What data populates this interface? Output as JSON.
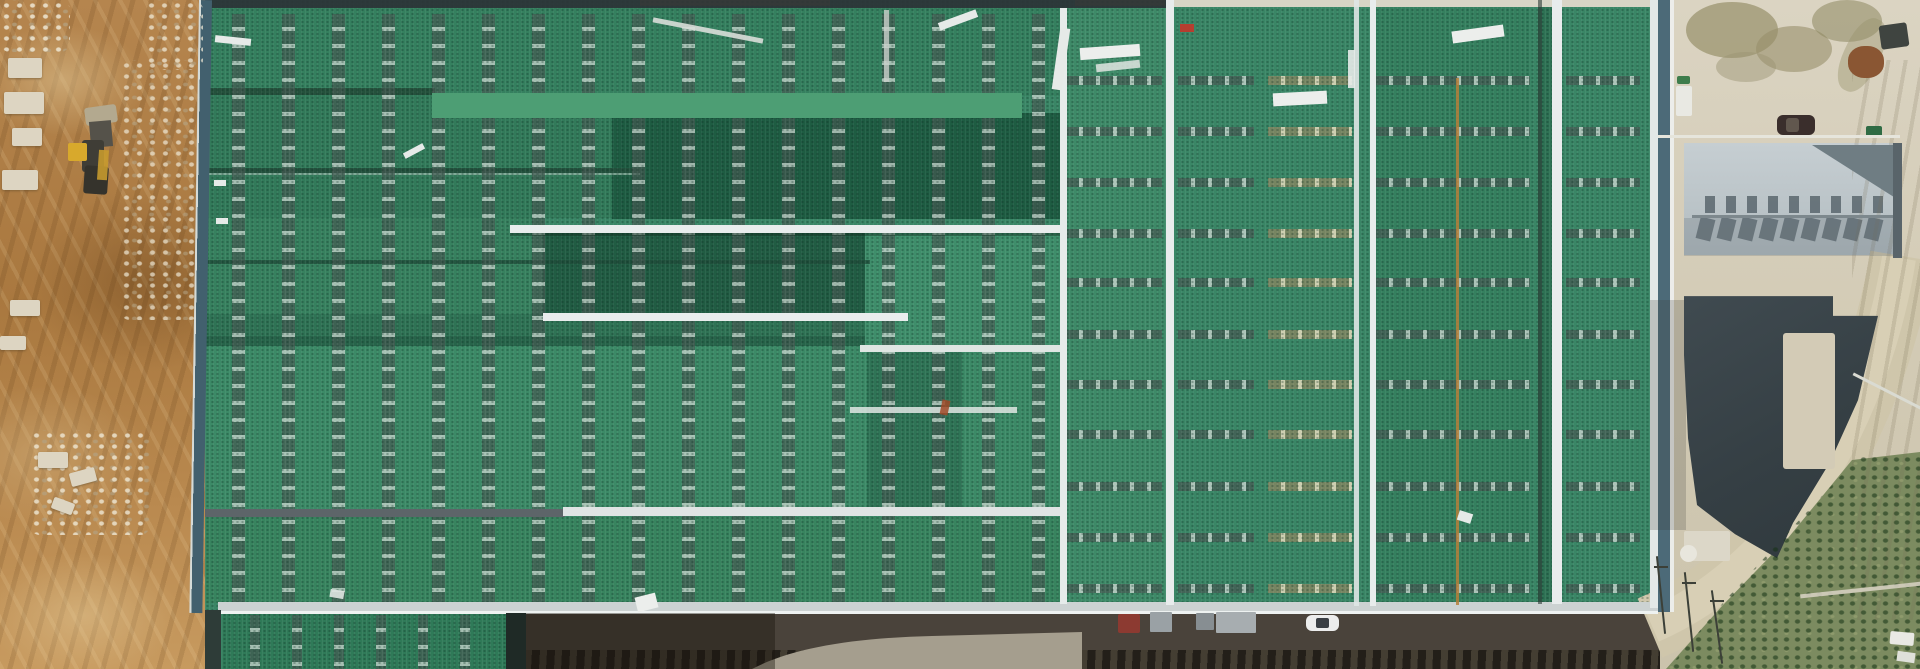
{
  "meta": {
    "title": "Aerial drone view of an industrial plant with large green metal roofs under construction"
  },
  "palette": {
    "dirt": "#b08049",
    "rubble": "#ddd5c2",
    "roof_green": "#3a8666",
    "roof_green_dark": "#1e5c42",
    "roof_green_bright": "#4d9e74",
    "seam_white": "#e8ecec",
    "edge_blue": "#4c6a78",
    "stripe_gray": "#8d9397",
    "stripe_tan": "#cdbf9e",
    "concrete": "#d6cfbc",
    "concrete_stain": "#97906a",
    "gray_roof_light": "#c6ced2",
    "gray_roof_mid": "#b2bcc0",
    "gray_roof_shadow": "#6f7d83",
    "charcoal_roof": "#39444a",
    "asphalt": "#4a433b",
    "road_light": "#a59e8e",
    "road_tan": "#cfc6ab",
    "road_tan_light": "#ddd5bc",
    "vegetation": "#7c8b60",
    "vegetation_dark": "#42613a",
    "excavator_yellow": "#d8a92c",
    "car_white": "#eceded",
    "truck_red": "#8c3a31",
    "car_dark": "#3a2e2c"
  },
  "scene": {
    "left_area": "Bare earth construction yard with wheel loader, rubble and tyre tracks",
    "main_area": "Large industrial hall with green metal roof, skylight vent strips, white walkways and ridge seams",
    "right_area": "Concrete yard with parked car, gray workshop building, dark curved roof, access road and scrub vegetation",
    "bottom_area": "Service road along the hall with red container truck, pallet stacks and a white car"
  },
  "stripes": {
    "columns": {
      "xs": [
        232,
        282,
        332,
        382,
        432,
        482,
        532,
        582,
        632,
        682,
        732,
        782,
        832,
        882,
        932,
        982,
        1032
      ],
      "top": 14,
      "height": 588
    },
    "lower": {
      "xs": [
        250,
        292,
        334,
        376,
        418,
        460
      ],
      "top": 615,
      "height": 54
    },
    "rows": {
      "ys": [
        76,
        127,
        178,
        229,
        278,
        330,
        380,
        430,
        482,
        533,
        584
      ],
      "bays": [
        {
          "x": 1066,
          "w": 96,
          "tan": false
        },
        {
          "x": 1178,
          "w": 76,
          "tan": false
        },
        {
          "x": 1268,
          "w": 84,
          "tan": true
        },
        {
          "x": 1376,
          "w": 154,
          "tan": false
        },
        {
          "x": 1566,
          "w": 74,
          "tan": false
        }
      ]
    }
  },
  "gray_building": {
    "teeth": {
      "x0": 1705,
      "step": 21,
      "count": 9,
      "sq_y": 196,
      "sh_y": 218
    }
  },
  "under": [
    {
      "n": "roof-band-top",
      "x": 205,
      "y": 8,
      "w": 857,
      "h": 88,
      "c": "#35805f"
    },
    {
      "n": "roof-ridge-dark",
      "x": 205,
      "y": 88,
      "w": 230,
      "h": 7,
      "c": "#24513c"
    },
    {
      "n": "roof-band-upper-left",
      "x": 205,
      "y": 95,
      "w": 407,
      "h": 123,
      "c": "#327a5a"
    },
    {
      "n": "roof-dark-rect",
      "x": 612,
      "y": 113,
      "w": 450,
      "h": 106,
      "c": "#1e5c42"
    },
    {
      "n": "roof-step-edge",
      "x": 205,
      "y": 168,
      "w": 435,
      "h": 5,
      "c": "#22503c"
    },
    {
      "n": "roof-step-highlight",
      "x": 205,
      "y": 173,
      "w": 435,
      "h": 2,
      "c": "#9fc2b2",
      "o": 0.7
    },
    {
      "n": "roof-band-mid-left",
      "x": 205,
      "y": 218,
      "w": 338,
      "h": 96,
      "c": "#37815f"
    },
    {
      "n": "roof-dark-bay",
      "x": 543,
      "y": 233,
      "w": 322,
      "h": 80,
      "c": "#215c43"
    },
    {
      "n": "roof-light-bay",
      "x": 865,
      "y": 233,
      "w": 197,
      "h": 112,
      "c": "#3f8e6b"
    },
    {
      "n": "roof-ridge-line",
      "x": 205,
      "y": 260,
      "w": 665,
      "h": 4,
      "c": "#1f4c39",
      "o": 0.8
    },
    {
      "n": "roof-band-4-left",
      "x": 205,
      "y": 314,
      "w": 660,
      "h": 22,
      "c": "#2f7355"
    },
    {
      "n": "roof-step-shadow",
      "x": 205,
      "y": 336,
      "w": 660,
      "h": 10,
      "c": "#27644a"
    },
    {
      "n": "roof-main-field",
      "x": 205,
      "y": 346,
      "w": 857,
      "h": 163,
      "c": "#3c8a67"
    },
    {
      "n": "roof-dark-strip-mid",
      "x": 867,
      "y": 346,
      "w": 95,
      "h": 163,
      "c": "#2f7456"
    },
    {
      "n": "roof-band-lower",
      "x": 205,
      "y": 517,
      "w": 857,
      "h": 86,
      "c": "#38845f"
    },
    {
      "n": "roof-mid-column",
      "x": 1062,
      "y": 8,
      "w": 104,
      "h": 596,
      "c": "#3e8a68"
    },
    {
      "n": "roof-right-block",
      "x": 1166,
      "y": 6,
      "w": 484,
      "h": 598,
      "c": "#3a8666"
    },
    {
      "n": "roof-bay-2",
      "x": 1376,
      "y": 6,
      "w": 154,
      "h": 598,
      "c": "#35805f"
    },
    {
      "n": "roof-bay-narrow",
      "x": 1538,
      "y": 6,
      "w": 14,
      "h": 598,
      "c": "#2e7254"
    },
    {
      "n": "top-dirt-gap",
      "x": 640,
      "y": 0,
      "w": 190,
      "h": 6,
      "c": "#a87c4a",
      "o": 0.9
    },
    {
      "n": "top-dirt-gap",
      "x": 1075,
      "y": 0,
      "w": 90,
      "h": 6,
      "c": "#a87c4a",
      "o": 0.8
    }
  ],
  "over": [
    {
      "n": "roof-eave-top-dark",
      "x": 205,
      "y": 0,
      "w": 962,
      "h": 8,
      "c": "#2b3336",
      "o": 0.92
    },
    {
      "n": "roof-eave-top-light",
      "x": 1167,
      "y": 0,
      "w": 488,
      "h": 7,
      "c": "#d8d5c6"
    },
    {
      "n": "roof-bright-ridge",
      "cls": "corr",
      "x": 432,
      "y": 93,
      "w": 590,
      "h": 25,
      "c": "#4d9e74"
    },
    {
      "n": "roof-walkway",
      "x": 510,
      "y": 225,
      "w": 553,
      "h": 8,
      "c": "#e9eded"
    },
    {
      "n": "roof-walkway-shadow",
      "x": 510,
      "y": 233,
      "w": 553,
      "h": 3,
      "c": "rgba(15,40,28,0.4)"
    },
    {
      "n": "roof-walkway",
      "x": 543,
      "y": 313,
      "w": 365,
      "h": 8,
      "c": "#e9eded"
    },
    {
      "n": "roof-step-white",
      "x": 860,
      "y": 345,
      "w": 203,
      "h": 7,
      "c": "#dfe6e3"
    },
    {
      "n": "roof-step-white",
      "x": 850,
      "y": 407,
      "w": 167,
      "h": 6,
      "c": "#dfe6e3",
      "o": 0.85
    },
    {
      "n": "roof-gray-bar",
      "x": 205,
      "y": 509,
      "w": 360,
      "h": 8,
      "c": "#5d6569"
    },
    {
      "n": "roof-white-bar",
      "x": 563,
      "y": 507,
      "w": 499,
      "h": 9,
      "c": "#dfe4e4"
    },
    {
      "n": "roof-eave-walkway",
      "x": 218,
      "y": 602,
      "w": 1440,
      "h": 11,
      "c": "#ccd2d2"
    },
    {
      "n": "roof-eave-walkway-edge",
      "x": 218,
      "y": 611,
      "w": 1440,
      "h": 3,
      "c": "#eef2f1"
    },
    {
      "n": "roof-seam-vertical",
      "x": 1060,
      "y": 8,
      "w": 7,
      "h": 596,
      "c": "#e6ebea"
    },
    {
      "n": "roof-seam-vertical",
      "x": 1166,
      "y": 0,
      "w": 8,
      "h": 605,
      "c": "#e8ecec"
    },
    {
      "n": "roof-seam-vertical",
      "x": 1354,
      "y": 0,
      "w": 5,
      "h": 606,
      "c": "#dfe5e4",
      "o": 0.9
    },
    {
      "n": "roof-seam-vertical",
      "x": 1370,
      "y": 0,
      "w": 6,
      "h": 606,
      "c": "#e8ecec"
    },
    {
      "n": "roof-seam-dark",
      "x": 1538,
      "y": 0,
      "w": 4,
      "h": 604,
      "c": "#2c3a36",
      "o": 0.6
    },
    {
      "n": "roof-seam-vertical",
      "x": 1552,
      "y": 0,
      "w": 10,
      "h": 604,
      "c": "#e8ecec"
    },
    {
      "n": "roof-rust-line",
      "x": 1456,
      "y": 78,
      "w": 3,
      "h": 527,
      "c": "#b5803c",
      "o": 0.85
    },
    {
      "n": "roof-seam-vertical",
      "x": 1650,
      "y": 0,
      "w": 8,
      "h": 608,
      "c": "#e3e8e7"
    },
    {
      "n": "building-right-edge",
      "x": 1658,
      "y": 0,
      "w": 12,
      "h": 612,
      "c": "#4c6a78"
    },
    {
      "n": "building-right-edge-line",
      "x": 1670,
      "y": 0,
      "w": 4,
      "h": 612,
      "c": "#eef0ee",
      "o": 0.9
    },
    {
      "n": "building-left-edge",
      "cls": "ledge",
      "x": 199,
      "y": 0,
      "w": 13,
      "h": 613
    },
    {
      "n": "building-left-edge-lower",
      "x": 205,
      "y": 610,
      "w": 16,
      "h": 59,
      "c": "#2e3c38"
    },
    {
      "n": "debris-plank",
      "x": 215,
      "y": 37,
      "w": 36,
      "h": 7,
      "c": "#e6eae8",
      "rot": 6
    },
    {
      "n": "debris-plank",
      "x": 214,
      "y": 180,
      "w": 12,
      "h": 6,
      "c": "#e6eae8"
    },
    {
      "n": "debris-plank",
      "x": 216,
      "y": 218,
      "w": 12,
      "h": 6,
      "c": "#e6eae8"
    },
    {
      "n": "debris-plank",
      "x": 403,
      "y": 148,
      "w": 22,
      "h": 6,
      "c": "#e6eae8",
      "rot": -28
    },
    {
      "n": "debris-plank",
      "x": 652,
      "y": 28,
      "w": 112,
      "h": 5,
      "c": "#d9ded9",
      "rot": 11,
      "o": 0.9
    },
    {
      "n": "debris-plank",
      "x": 884,
      "y": 10,
      "w": 5,
      "h": 72,
      "c": "#c9d0ca",
      "o": 0.8
    },
    {
      "n": "debris-plank",
      "x": 938,
      "y": 16,
      "w": 40,
      "h": 8,
      "c": "#e6eae8",
      "rot": -20
    },
    {
      "n": "debris-plank",
      "x": 1056,
      "y": 28,
      "w": 10,
      "h": 62,
      "c": "#e6eae8",
      "rot": 8
    },
    {
      "n": "debris-plank",
      "x": 1080,
      "y": 46,
      "w": 60,
      "h": 12,
      "c": "#eceeec",
      "rot": -4
    },
    {
      "n": "debris-plank",
      "x": 1096,
      "y": 62,
      "w": 44,
      "h": 8,
      "c": "#e0e5e2",
      "rot": -6,
      "o": 0.85
    },
    {
      "n": "debris-plank",
      "x": 1273,
      "y": 92,
      "w": 54,
      "h": 13,
      "c": "#eceeec",
      "rot": -3
    },
    {
      "n": "debris-plank",
      "x": 1348,
      "y": 50,
      "w": 7,
      "h": 38,
      "c": "#e6eae8",
      "o": 0.9
    },
    {
      "n": "debris-plank",
      "x": 1452,
      "y": 28,
      "w": 52,
      "h": 12,
      "c": "#eceeec",
      "rot": -8
    },
    {
      "n": "debris-red-mark",
      "x": 1180,
      "y": 24,
      "w": 14,
      "h": 8,
      "c": "#b53e30"
    },
    {
      "n": "debris-sheet",
      "x": 1458,
      "y": 512,
      "w": 14,
      "h": 10,
      "c": "#e6eae8",
      "rot": 18
    },
    {
      "n": "debris-sheet",
      "x": 636,
      "y": 595,
      "w": 21,
      "h": 15,
      "c": "#eceeec",
      "rot": -14
    },
    {
      "n": "debris-sheet",
      "x": 330,
      "y": 590,
      "w": 14,
      "h": 8,
      "c": "#e0e5e2",
      "rot": 10,
      "o": 0.9
    },
    {
      "n": "debris-rust-mark",
      "x": 941,
      "y": 400,
      "w": 8,
      "h": 15,
      "c": "#a14a28",
      "rot": 12,
      "o": 0.85
    },
    {
      "n": "rubble-patch",
      "cls": "rubble",
      "x": 120,
      "y": 60,
      "w": 80,
      "h": 260,
      "o": 0.75
    },
    {
      "n": "rubble-patch",
      "cls": "rubble",
      "x": 145,
      "y": 0,
      "w": 58,
      "h": 70,
      "o": 0.8
    },
    {
      "n": "rubble-patch",
      "cls": "rubble",
      "x": 0,
      "y": 0,
      "w": 70,
      "h": 52,
      "o": 0.9
    },
    {
      "n": "rubble-patch",
      "cls": "rubble",
      "x": 30,
      "y": 430,
      "w": 120,
      "h": 105,
      "o": 0.85
    },
    {
      "n": "stone-block",
      "cls": "stone",
      "x": 8,
      "y": 58,
      "w": 34,
      "h": 20
    },
    {
      "n": "stone-block",
      "cls": "stone",
      "x": 4,
      "y": 92,
      "w": 40,
      "h": 22
    },
    {
      "n": "stone-block",
      "cls": "stone",
      "x": 12,
      "y": 128,
      "w": 30,
      "h": 18
    },
    {
      "n": "stone-block",
      "cls": "stone",
      "x": 2,
      "y": 170,
      "w": 36,
      "h": 20
    },
    {
      "n": "stone-block",
      "cls": "stone",
      "x": 10,
      "y": 300,
      "w": 30,
      "h": 16
    },
    {
      "n": "stone-block",
      "cls": "stone",
      "x": 0,
      "y": 336,
      "w": 26,
      "h": 14
    },
    {
      "n": "stone-block",
      "cls": "stone",
      "x": 38,
      "y": 452,
      "w": 30,
      "h": 16
    },
    {
      "n": "stone-block",
      "cls": "stone",
      "x": 70,
      "y": 470,
      "w": 26,
      "h": 14,
      "rot": -15
    },
    {
      "n": "stone-block",
      "cls": "stone",
      "x": 52,
      "y": 500,
      "w": 22,
      "h": 12,
      "rot": 20
    },
    {
      "n": "excavator-bucket",
      "x": 85,
      "y": 106,
      "w": 32,
      "h": 18,
      "c": "#b3a98f",
      "rot": -8,
      "r": 3
    },
    {
      "n": "excavator-arm",
      "x": 90,
      "y": 121,
      "w": 22,
      "h": 26,
      "c": "#55524a",
      "rot": -5
    },
    {
      "n": "excavator-body",
      "x": 82,
      "y": 140,
      "w": 22,
      "h": 32,
      "c": "#3f3d36",
      "r": 3
    },
    {
      "n": "excavator-cab",
      "x": 68,
      "y": 143,
      "w": 19,
      "h": 18,
      "c": "#d8a92c",
      "r": 2
    },
    {
      "n": "excavator-rear",
      "x": 84,
      "y": 166,
      "w": 24,
      "h": 28,
      "c": "#35332c",
      "r": 3,
      "rot": 4
    },
    {
      "n": "excavator-side",
      "x": 98,
      "y": 150,
      "w": 10,
      "h": 30,
      "c": "#c79a2e",
      "o": 0.9,
      "rot": 4
    },
    {
      "n": "ground-shadow",
      "x": 525,
      "y": 613,
      "w": 250,
      "h": 56,
      "c": "rgba(25,20,12,0.4)"
    },
    {
      "n": "lower-roof-edge-shadow",
      "x": 506,
      "y": 613,
      "w": 20,
      "h": 56,
      "c": "#1f2a26"
    },
    {
      "n": "cargo-truck-red",
      "x": 1118,
      "y": 614,
      "w": 22,
      "h": 19,
      "c": "#8c3a31",
      "r": 2
    },
    {
      "n": "pallet-stack",
      "x": 1150,
      "y": 612,
      "w": 22,
      "h": 20,
      "c": "#9aa1a5",
      "r": 1
    },
    {
      "n": "pallet-stack",
      "x": 1196,
      "y": 613,
      "w": 18,
      "h": 17,
      "c": "#878e92",
      "r": 1
    },
    {
      "n": "pallet-stack",
      "x": 1216,
      "y": 612,
      "w": 40,
      "h": 21,
      "c": "#a7adb0",
      "r": 1
    },
    {
      "n": "car-white",
      "x": 1306,
      "y": 615,
      "w": 33,
      "h": 16,
      "c": "#eceded",
      "r": 6
    },
    {
      "n": "car-white-windshield",
      "x": 1316,
      "y": 618,
      "w": 13,
      "h": 10,
      "c": "#3a3f44",
      "r": 2
    },
    {
      "n": "concrete-stain",
      "x": 1686,
      "y": 2,
      "w": 92,
      "h": 56,
      "c": "#97906a",
      "r": "50%",
      "o": 0.7
    },
    {
      "n": "concrete-stain",
      "x": 1756,
      "y": 26,
      "w": 76,
      "h": 46,
      "c": "#97906a",
      "r": "50%",
      "o": 0.6
    },
    {
      "n": "concrete-stain",
      "x": 1812,
      "y": 0,
      "w": 70,
      "h": 42,
      "c": "#8d8660",
      "r": "50%",
      "o": 0.55
    },
    {
      "n": "concrete-stain",
      "x": 1716,
      "y": 52,
      "w": 60,
      "h": 30,
      "c": "#9a9370",
      "r": "50%",
      "o": 0.45
    },
    {
      "n": "concrete-stain",
      "x": 1844,
      "y": 16,
      "w": 36,
      "h": 78,
      "c": "#97906a",
      "r": "45%",
      "o": 0.4,
      "rot": 25
    },
    {
      "n": "tire-tracks",
      "cls": "tracks",
      "x": 1852,
      "y": 60,
      "w": 68,
      "h": 560,
      "o": 0.7
    },
    {
      "n": "rust-pile",
      "x": 1848,
      "y": 46,
      "w": 36,
      "h": 32,
      "c": "#8a5633",
      "r": "45%"
    },
    {
      "n": "equipment-dark",
      "x": 1880,
      "y": 24,
      "w": 28,
      "h": 24,
      "c": "#3f4440",
      "r": 3,
      "rot": -8
    },
    {
      "n": "utility-box-white",
      "x": 1676,
      "y": 86,
      "w": 16,
      "h": 30,
      "c": "#e9e9e3",
      "r": 2
    },
    {
      "n": "dumpster-green",
      "x": 1677,
      "y": 76,
      "w": 13,
      "h": 8,
      "c": "#3e7d4c",
      "r": 2
    },
    {
      "n": "dumpster-green",
      "x": 1866,
      "y": 126,
      "w": 16,
      "h": 11,
      "c": "#2f6b44",
      "r": 2
    },
    {
      "n": "car-dark",
      "x": 1777,
      "y": 115,
      "w": 38,
      "h": 20,
      "c": "#3a2e2c",
      "r": 6
    },
    {
      "n": "car-dark-roof",
      "x": 1786,
      "y": 118,
      "w": 13,
      "h": 14,
      "c": "#6b6158",
      "o": 0.8,
      "r": 3
    },
    {
      "n": "yard-fence",
      "x": 1658,
      "y": 135,
      "w": 242,
      "h": 3,
      "c": "#e6e5dc"
    },
    {
      "n": "gray-roof-shadow-triangle",
      "cls": "tri",
      "x": 1812,
      "y": 145,
      "w": 85,
      "h": 54,
      "c": "#6f7d83"
    },
    {
      "n": "gray-roof-ridge",
      "x": 1692,
      "y": 215,
      "w": 202,
      "h": 3,
      "c": "#7d888d"
    },
    {
      "n": "gray-roof-lower-shade",
      "x": 1684,
      "y": 218,
      "w": 213,
      "h": 38,
      "c": "rgba(95,108,114,0.25)"
    },
    {
      "n": "gray-building-right-wall",
      "x": 1893,
      "y": 143,
      "w": 9,
      "h": 115,
      "c": "#59646a"
    },
    {
      "n": "yard-shade",
      "x": 1650,
      "y": 300,
      "w": 36,
      "h": 230,
      "c": "rgba(60,60,55,0.22)"
    },
    {
      "n": "charcoal-roof",
      "cls": "charcoal",
      "x": 1650,
      "y": 250,
      "w": 250,
      "h": 320
    },
    {
      "n": "courtyard-concrete",
      "x": 1783,
      "y": 333,
      "w": 52,
      "h": 136,
      "c": "#d3cbb6",
      "r": 3
    },
    {
      "n": "vegetation-texture",
      "cls": "vegtex",
      "x": 1660,
      "y": 455,
      "w": 260,
      "h": 214
    },
    {
      "n": "concrete-pad",
      "x": 1684,
      "y": 531,
      "w": 46,
      "h": 30,
      "c": "#dcd7c8",
      "r": 2
    },
    {
      "n": "storage-tank",
      "x": 1680,
      "y": 545,
      "w": 17,
      "h": 17,
      "c": "#e8e6dd",
      "r": "50%"
    },
    {
      "n": "railing",
      "x": 1849,
      "y": 390,
      "w": 78,
      "h": 3,
      "c": "#dadbd2",
      "rot": 27
    },
    {
      "n": "utility-pole",
      "x": 1660,
      "y": 556,
      "w": 2,
      "h": 78,
      "c": "#3c4038",
      "rot": -6
    },
    {
      "n": "utility-pole",
      "x": 1688,
      "y": 572,
      "w": 2,
      "h": 80,
      "c": "#3c4038",
      "rot": -6
    },
    {
      "n": "utility-pole",
      "x": 1716,
      "y": 590,
      "w": 2,
      "h": 74,
      "c": "#3c4038",
      "rot": -8
    },
    {
      "n": "utility-pole-crossarm",
      "x": 1654,
      "y": 566,
      "w": 14,
      "h": 2,
      "c": "#3c4038"
    },
    {
      "n": "utility-pole-crossarm",
      "x": 1682,
      "y": 582,
      "w": 14,
      "h": 2,
      "c": "#3c4038"
    },
    {
      "n": "utility-pole-crossarm",
      "x": 1710,
      "y": 600,
      "w": 14,
      "h": 2,
      "c": "#3c4038"
    },
    {
      "n": "pipe-rail",
      "x": 1800,
      "y": 588,
      "w": 122,
      "h": 4,
      "c": "#d5cfc0",
      "rot": -6,
      "o": 0.9
    },
    {
      "n": "vehicle-white",
      "x": 1890,
      "y": 632,
      "w": 24,
      "h": 13,
      "c": "#e9e9e4",
      "r": 2,
      "rot": 5
    },
    {
      "n": "vehicle-white",
      "x": 1897,
      "y": 652,
      "w": 18,
      "h": 10,
      "c": "#dfe0da",
      "rot": 8
    }
  ]
}
